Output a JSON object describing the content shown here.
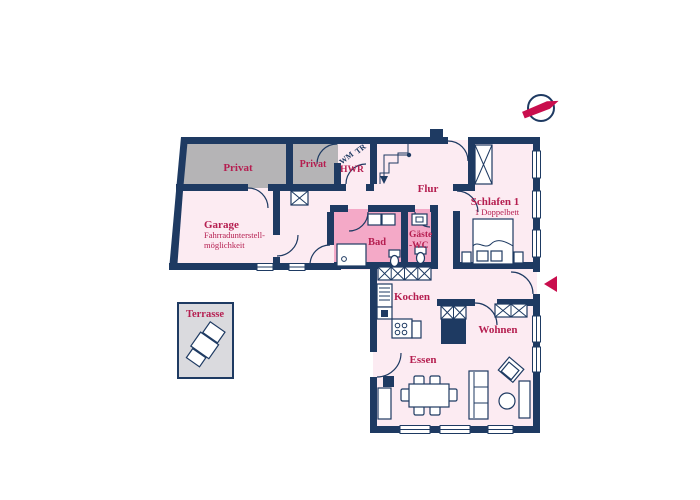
{
  "rooms": {
    "privat1": {
      "label": "Privat"
    },
    "privat2": {
      "label": "Privat"
    },
    "hwr": {
      "label": "HWR",
      "appliance1": "WM",
      "appliance2": "TR"
    },
    "flur": {
      "label": "Flur"
    },
    "schlafen1": {
      "label": "Schlafen 1",
      "sublabel": "1 Doppelbett"
    },
    "garage": {
      "label": "Garage",
      "subline1": "Fahrradunterstell-",
      "subline2": "möglichkeit"
    },
    "bad": {
      "label": "Bad"
    },
    "gaeste_wc": {
      "line1": "Gäste",
      "line2": "-WC"
    },
    "kochen": {
      "label": "Kochen"
    },
    "wohnen": {
      "label": "Wohnen"
    },
    "essen": {
      "label": "Essen"
    },
    "terrasse": {
      "label": "Terrasse"
    }
  },
  "icons": {
    "compass": "compass-north-icon",
    "entrance_arrow": "entrance-direction-icon",
    "stairs": "stairs-down-icon"
  },
  "colors": {
    "wall": "#1e3a62",
    "floor": "#fcebf2",
    "wet": "#f4a9c7",
    "private": "#b5b4b6",
    "terrace": "#dadade",
    "label": "#b51e50",
    "accent": "#c90e4d",
    "bg": "#ffffff"
  }
}
